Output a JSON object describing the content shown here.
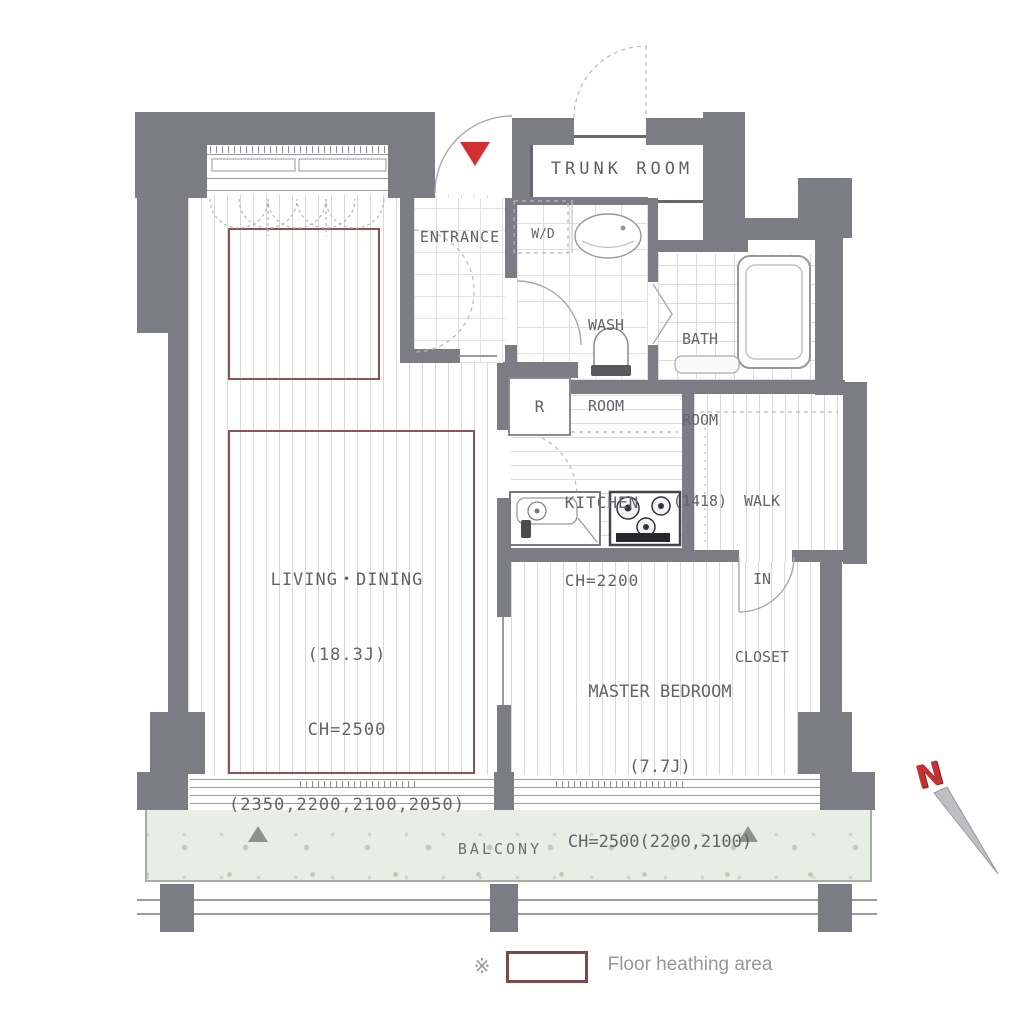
{
  "rooms": {
    "trunk_room": {
      "label": "TRUNK ROOM"
    },
    "entrance": {
      "label": "ENTRANCE"
    },
    "washer_dryer": {
      "label": "W/D"
    },
    "wash_room": {
      "line1": "WASH",
      "line2": "ROOM"
    },
    "bath_room": {
      "line1": "BATH",
      "line2": "ROOM",
      "line3": "(1418)"
    },
    "kitchen": {
      "line1": "KITCHEN",
      "line2": "CH=2200"
    },
    "refrigerator": {
      "label": "R"
    },
    "walk_in_closet": {
      "line1": "WALK",
      "line2": "IN",
      "line3": "CLOSET"
    },
    "living_dining": {
      "line1": "LIVING・DINING",
      "line2": "(18.3J)",
      "line3": "CH=2500",
      "line4": "(2350,2200,2100,2050)"
    },
    "master_bedroom": {
      "line1": "MASTER BEDROOM",
      "line2": "(7.7J)",
      "line3": "CH=2500(2200,2100)"
    },
    "balcony": {
      "label": "BALCONY"
    }
  },
  "legend": {
    "marker": "※",
    "floor_heating": "Floor heathing area"
  },
  "compass": {
    "north": "N"
  },
  "colors": {
    "wall": "#7c7c84",
    "floor_heating_outline": "#8a5454",
    "entrance_marker_red": "#d23030",
    "north_n_red": "#c23232",
    "balcony_fill": "#e9eee5"
  }
}
